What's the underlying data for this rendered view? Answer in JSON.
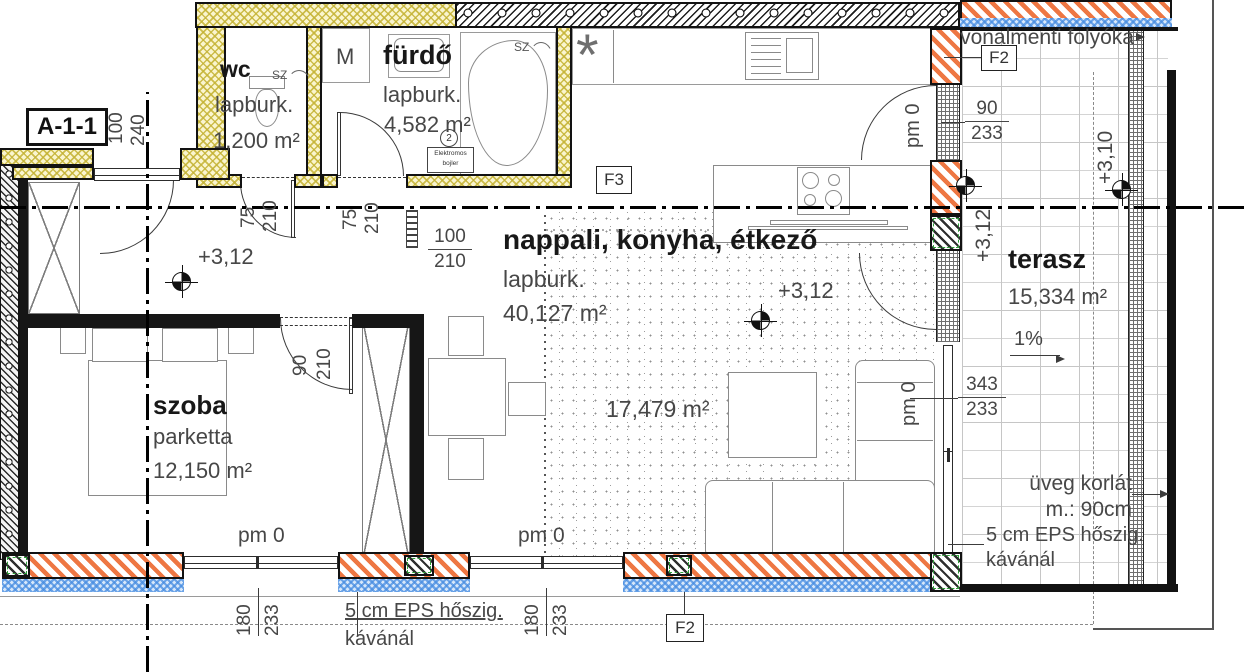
{
  "section_label": "A-1-1",
  "rooms": {
    "wc": {
      "name": "wc",
      "finish": "lapburk.",
      "area": "1,200 m²"
    },
    "furdo": {
      "name": "fürdő",
      "finish": "lapburk.",
      "area": "4,582 m²"
    },
    "nappali": {
      "name": "nappali, konyha, étkező",
      "finish": "lapburk.",
      "area": "40,127 m²",
      "area2": "17,479 m²"
    },
    "szoba": {
      "name": "szoba",
      "finish": "parketta",
      "area": "12,150 m²"
    },
    "terasz": {
      "name": "terasz",
      "area": "15,334 m²",
      "slope": "1%"
    }
  },
  "levels": {
    "hall": "+3,12",
    "living": "+3,12",
    "terrace_inner": "+3,12",
    "terrace_outer": "+3,10"
  },
  "datum": {
    "pm_window1": "pm 0",
    "pm_window2": "pm 0",
    "pm_east_door": "pm 0",
    "pm_slider": "pm 0"
  },
  "dimensions": {
    "entry_width": "100",
    "entry_height": "240",
    "wc_door_width": "75",
    "wc_door_height": "210",
    "bath_door_width": "75",
    "bath_door_height": "210",
    "pass_width": "100",
    "pass_height": "210",
    "szoba_door_width": "90",
    "szoba_door_height": "210",
    "east_door_width": "90",
    "east_door_height": "233",
    "slider_width": "343",
    "slider_height": "233",
    "window1_width": "180",
    "window1_height": "233",
    "window2_width": "180",
    "window2_height": "233"
  },
  "tags": {
    "f3": "F3",
    "f2_top": "F2",
    "f2_bottom": "F2"
  },
  "notes": {
    "drain": "vonalmenti folyóka",
    "railing_line1": "üveg korlát",
    "railing_line2": "m.: 90cm",
    "eps_terrace_line1": "5 cm EPS hőszig.",
    "eps_terrace_line2": "kávánál",
    "eps_bottom_line1": "5 cm EPS hőszig.",
    "eps_bottom_line2": "kávánál",
    "boiler_line1": "Elektromos",
    "boiler_line2": "bojler",
    "washing_machine": "M",
    "vent": "SZ",
    "heating_circle": "2",
    "ceiling_symbol": "*"
  },
  "colors": {
    "wall_orange": "#ee7743",
    "wall_yellow": "#d6c75f",
    "insulation_blue": "#76b0ea",
    "line": "#141414",
    "text": "#3f3f3f"
  }
}
